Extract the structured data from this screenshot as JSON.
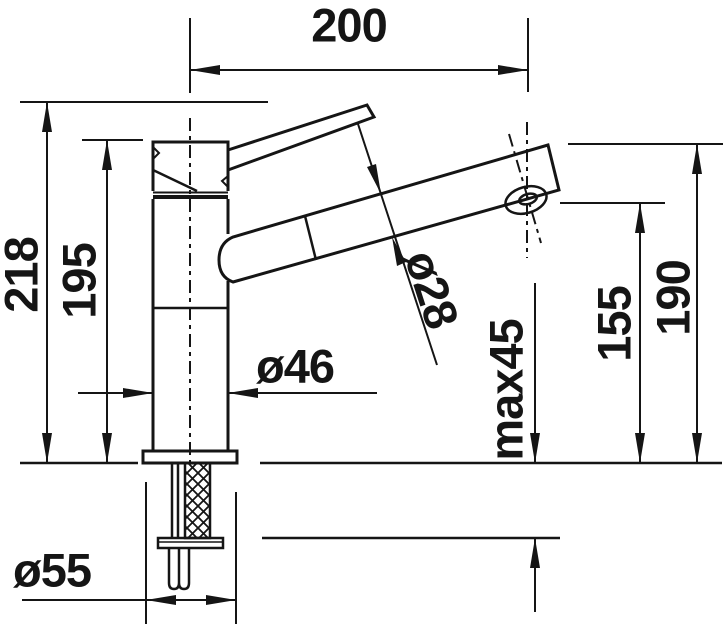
{
  "drawing": {
    "kind": "technical dimension drawing",
    "subject": "single-lever kitchen mixer tap, side elevation with mounting section",
    "line_color": "#151515",
    "background_color": "#ffffff"
  },
  "labels": {
    "spout_reach": "200",
    "overall_height": "218",
    "body_top_height": "195",
    "spout_tube_diameter": "ø28",
    "body_diameter": "ø46",
    "max_mounting_thickness": "max45",
    "outlet_height": "155",
    "spout_end_height": "190",
    "base_diameter": "ø55"
  }
}
